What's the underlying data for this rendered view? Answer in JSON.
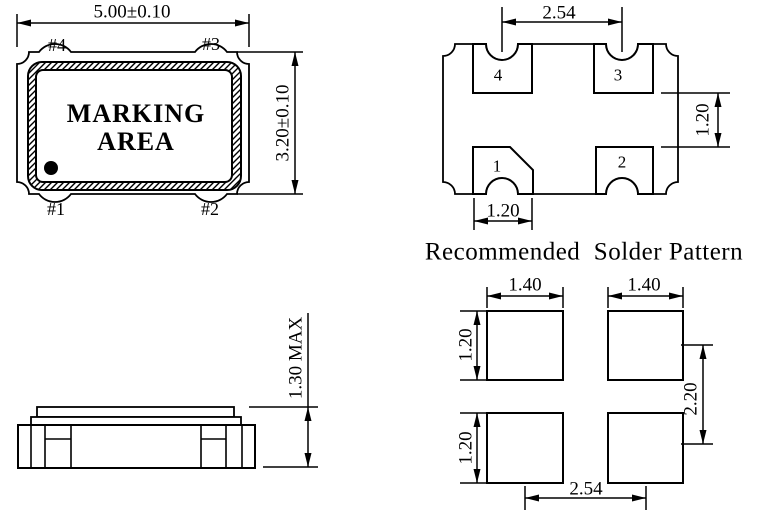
{
  "colors": {
    "ink": "#000000",
    "paper": "#ffffff"
  },
  "top_view": {
    "width_dim": "5.00±0.10",
    "height_dim": "3.20±0.10",
    "marking_area_line1": "MARKING",
    "marking_area_line2": "AREA",
    "pad1_label": "#1",
    "pad2_label": "#2",
    "pad3_label": "#3",
    "pad4_label": "#4"
  },
  "bottom_view": {
    "pitch_dim": "2.54",
    "pad_height_dim": "1.20",
    "pad_width_dim": "1.20",
    "pad1": "1",
    "pad2": "2",
    "pad3": "3",
    "pad4": "4"
  },
  "side_view": {
    "height_dim": "1.30 MAX"
  },
  "solder_pattern": {
    "title": "Recommended  Solder Pattern",
    "pad_width_left_dim": "1.40",
    "pad_width_right_dim": "1.40",
    "pad_height_top_dim": "1.20",
    "pad_height_bottom_dim": "1.20",
    "vertical_pitch_dim": "2.20",
    "horizontal_pitch_dim": "2.54"
  }
}
